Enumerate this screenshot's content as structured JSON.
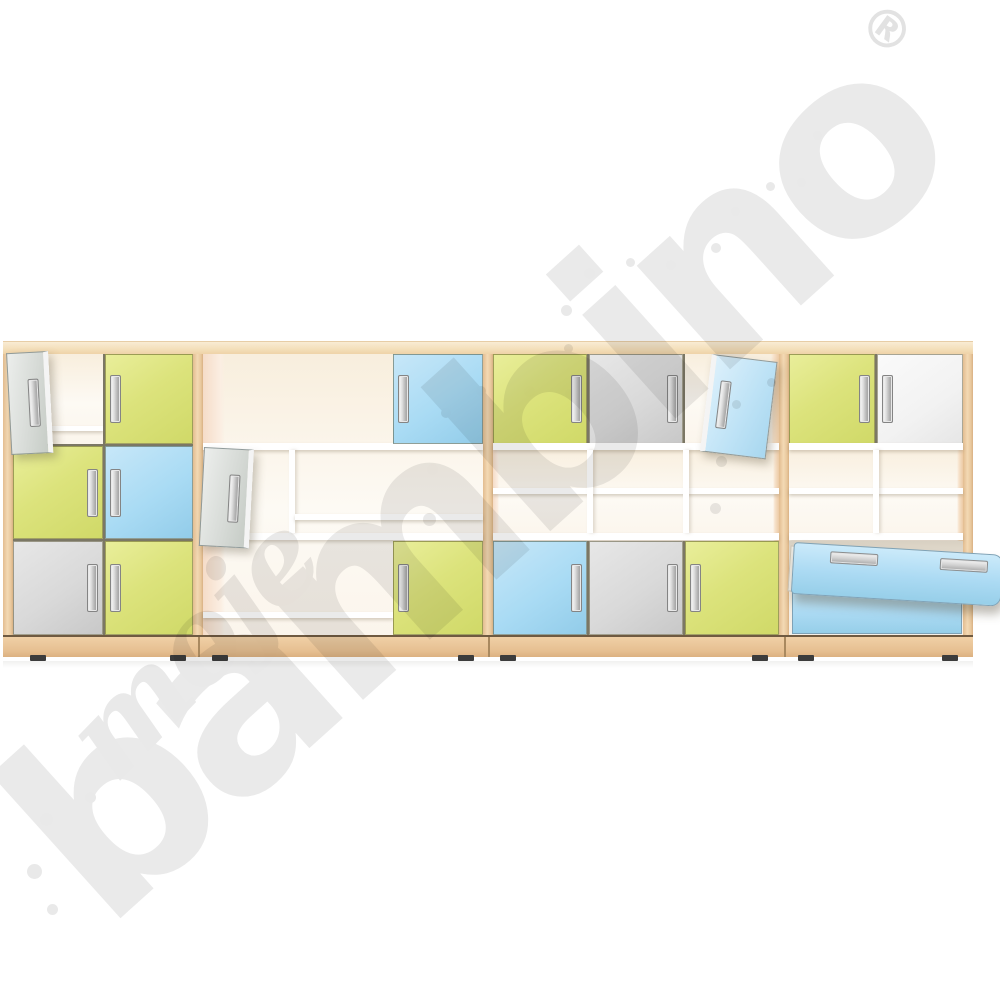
{
  "scene": {
    "type": "product-photo",
    "subject": "Set of four children's storage cabinets with maple wood frames, coloured fronts (lime, light blue, grey, white), open shelf compartments and one pulled-out drawer",
    "background": "#ffffff"
  },
  "watermark": {
    "script_word": "moje",
    "main_word": "bambino",
    "registered_symbol": "®",
    "color": "#e9e9e9",
    "dots": [
      [
        813,
        131,
        9
      ],
      [
        797,
        178,
        9
      ],
      [
        766,
        182,
        9
      ],
      [
        731,
        207,
        9
      ],
      [
        711,
        243,
        10
      ],
      [
        666,
        260,
        10
      ],
      [
        626,
        258,
        9
      ],
      [
        584,
        268,
        11
      ],
      [
        561,
        305,
        11
      ],
      [
        564,
        344,
        9
      ],
      [
        524,
        386,
        11
      ],
      [
        565,
        389,
        9
      ],
      [
        767,
        378,
        9
      ],
      [
        732,
        400,
        9
      ],
      [
        716,
        456,
        11
      ],
      [
        710,
        503,
        11
      ],
      [
        476,
        386,
        10
      ],
      [
        441,
        408,
        10
      ],
      [
        427,
        464,
        11
      ],
      [
        423,
        513,
        13
      ],
      [
        85,
        792,
        11
      ],
      [
        40,
        813,
        13
      ],
      [
        27,
        864,
        15
      ],
      [
        47,
        904,
        11
      ]
    ]
  },
  "palette": {
    "wood_frame": "#ecc9a1",
    "wood_top": "#f5e1c2",
    "wood_plinth": "#e9c69c",
    "door_lime": "#dce37c",
    "door_blue": "#a9dbf4",
    "door_gray": "#d9d9d9",
    "door_white": "#f2f2f2",
    "drawer_blue": "#abdaf3",
    "interior_back": "#f8eedd",
    "handle_silver": "#d9d9d9",
    "feet_dark": "#3c3c3c"
  },
  "units": [
    {
      "id": "unit-1",
      "grid": "2 columns x 3 rows",
      "cells": [
        "grey door (open)",
        "lime door",
        "lime door",
        "blue door",
        "grey door",
        "lime door"
      ]
    },
    {
      "id": "unit-2",
      "grid": "3 columns x 3 rows",
      "cells": [
        "open",
        "open",
        "blue door",
        "grey door (open)",
        "open shelf",
        "open shelf",
        "open",
        "open",
        "lime door"
      ]
    },
    {
      "id": "unit-3",
      "grid": "3 columns x 3 rows",
      "cells": [
        "lime door",
        "grey door",
        "blue door (open)",
        "open shelf",
        "open shelf",
        "open shelf",
        "blue door",
        "grey door",
        "lime door"
      ]
    },
    {
      "id": "unit-4",
      "grid": "2 columns x 3 rows",
      "cells": [
        "lime door",
        "white door",
        "open shelf",
        "open shelf",
        "blue drawer (pulled out)",
        "blue drawer"
      ]
    }
  ]
}
